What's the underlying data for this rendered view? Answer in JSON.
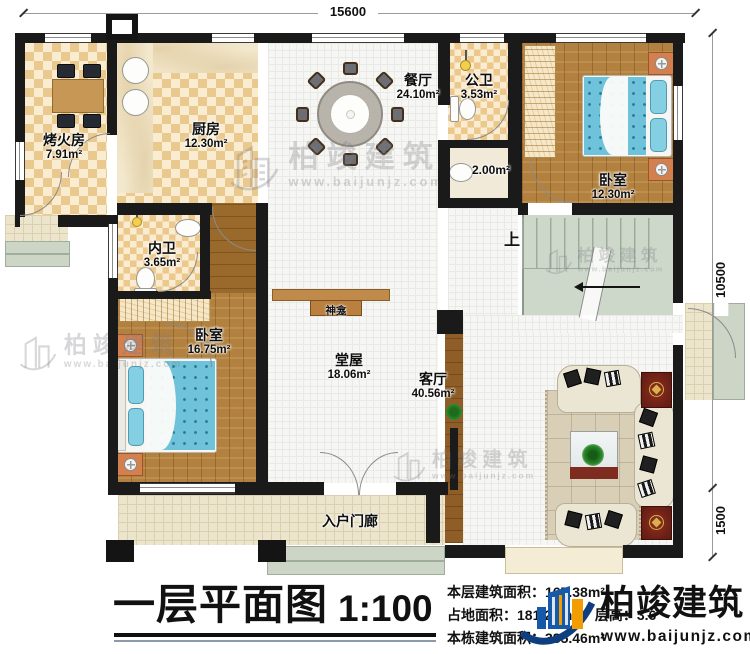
{
  "dimensions": {
    "top": "15600",
    "right_upper": "10500",
    "right_lower": "1500"
  },
  "rooms": [
    {
      "id": "kaohuofang",
      "name": "烤火房",
      "area": "7.91m²"
    },
    {
      "id": "kitchen",
      "name": "厨房",
      "area": "12.30m²"
    },
    {
      "id": "dining",
      "name": "餐厅",
      "area": "24.10m²"
    },
    {
      "id": "public-bath",
      "name": "公卫",
      "area": "3.53m²"
    },
    {
      "id": "washroom",
      "name": "",
      "area": "2.00m²"
    },
    {
      "id": "bedroom-top",
      "name": "卧室",
      "area": "12.30m²"
    },
    {
      "id": "inner-bath",
      "name": "内卫",
      "area": "3.65m²"
    },
    {
      "id": "bedroom-left",
      "name": "卧室",
      "area": "16.75m²"
    },
    {
      "id": "main-hall",
      "name": "堂屋",
      "area": "18.06m²"
    },
    {
      "id": "living-room",
      "name": "客厅",
      "area": "40.56m²"
    }
  ],
  "labels": {
    "shrine": "神龛",
    "stairs_up": "上",
    "porch": "入户门廊"
  },
  "footer": {
    "title": "一层平面图",
    "scale": "1:100",
    "stats": [
      "本层建筑面积：167.38m²",
      "占地面积：181.28m²",
      "层高：3.6",
      "本栋建筑面积：385.46m²"
    ]
  },
  "brand": {
    "name": "柏竣建筑",
    "website": "www.baijunjz.com"
  },
  "watermark": {
    "name": "柏竣建筑",
    "website": "www.baijunjz.com"
  },
  "colors": {
    "wall": "#1a1a1a",
    "checker": "#eac98e",
    "wood": "#b2813f",
    "mattress": "#6ec2da",
    "brand_blue": "#1659a8",
    "brand_orange": "#f49d00"
  }
}
